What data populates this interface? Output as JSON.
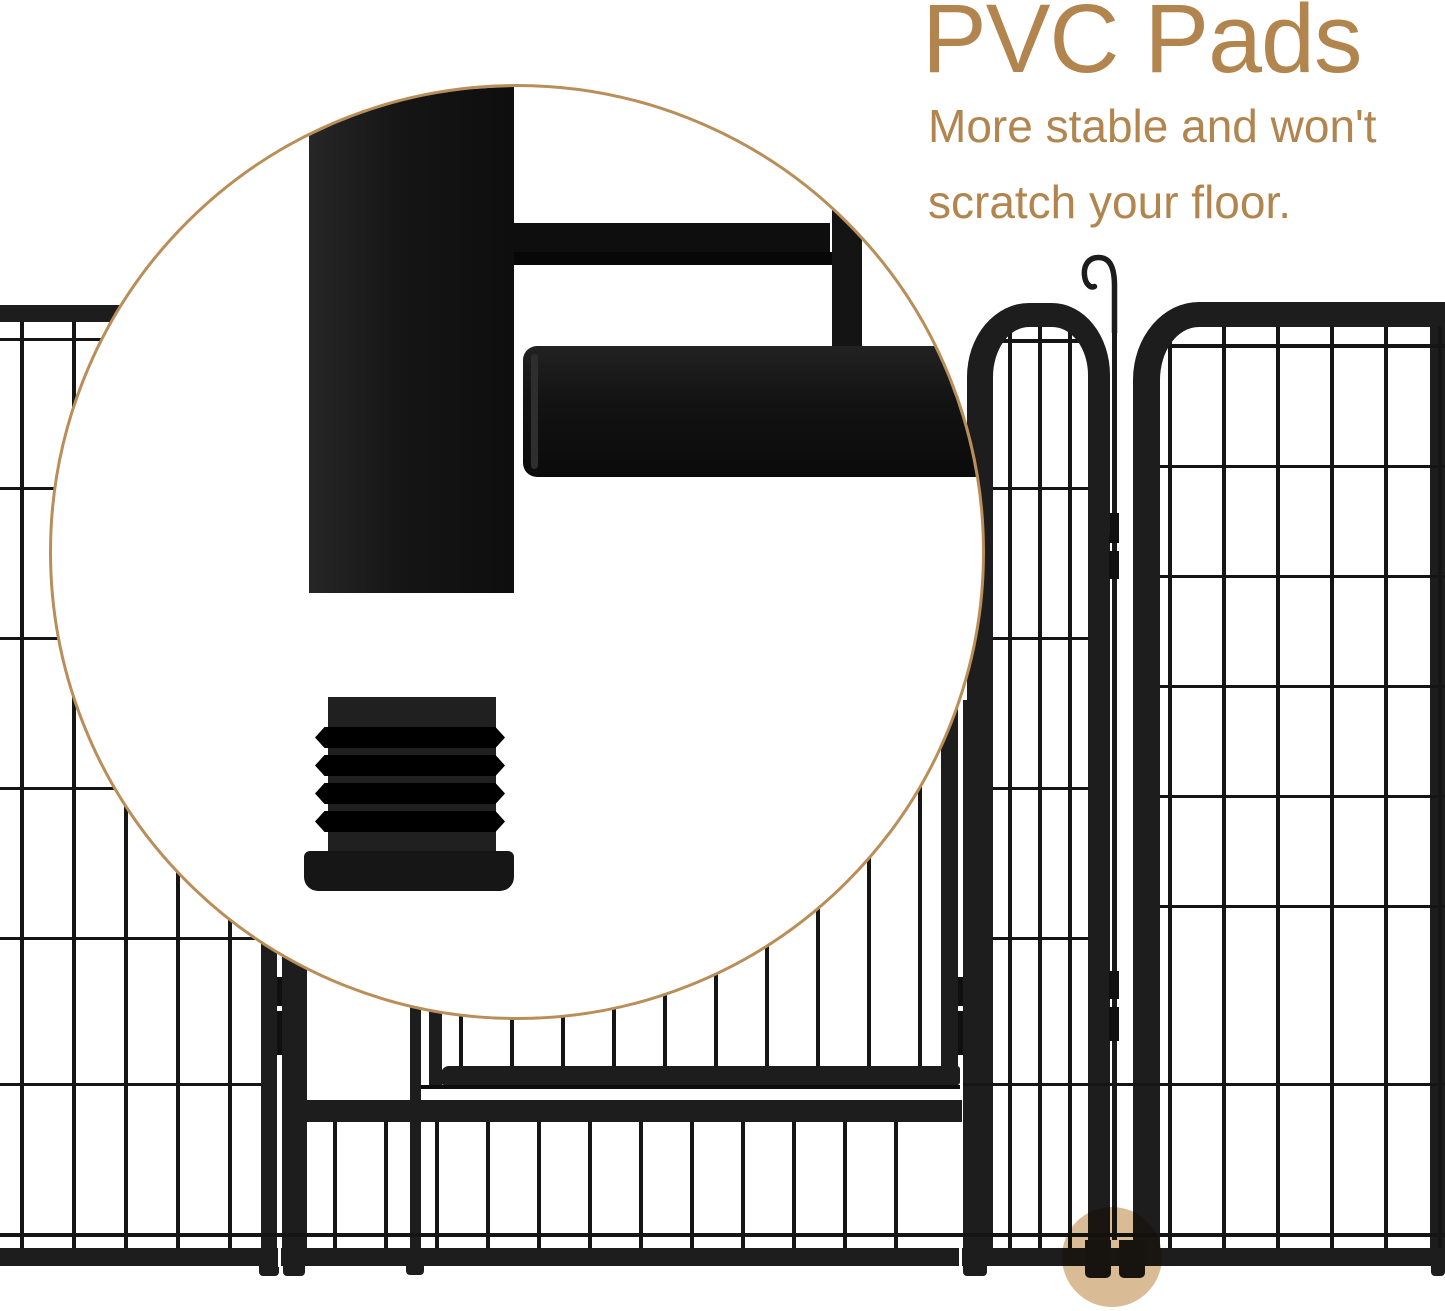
{
  "callout": {
    "title": "PVC Pads",
    "subtitle_line1": "More stable and won't",
    "subtitle_line2": "scratch your floor."
  },
  "colors": {
    "accent_text": "#b2854f",
    "callout_ring": "#b98e58",
    "fence_metal": "#1d1d1d",
    "fence_wire": "#151515",
    "floor_highlight": "#d9bc96"
  },
  "icons": [
    {
      "name": "magnifier-callout-circle",
      "meaning": "zoomed detail of fence foot"
    },
    {
      "name": "latch-hook-icon",
      "meaning": "gate latch hook on panel junction"
    },
    {
      "name": "pvc-pad-foot",
      "meaning": "ribbed PVC floor pad plug"
    },
    {
      "name": "floor-highlight-dot",
      "meaning": "tan circle marking pad location on fence"
    }
  ]
}
